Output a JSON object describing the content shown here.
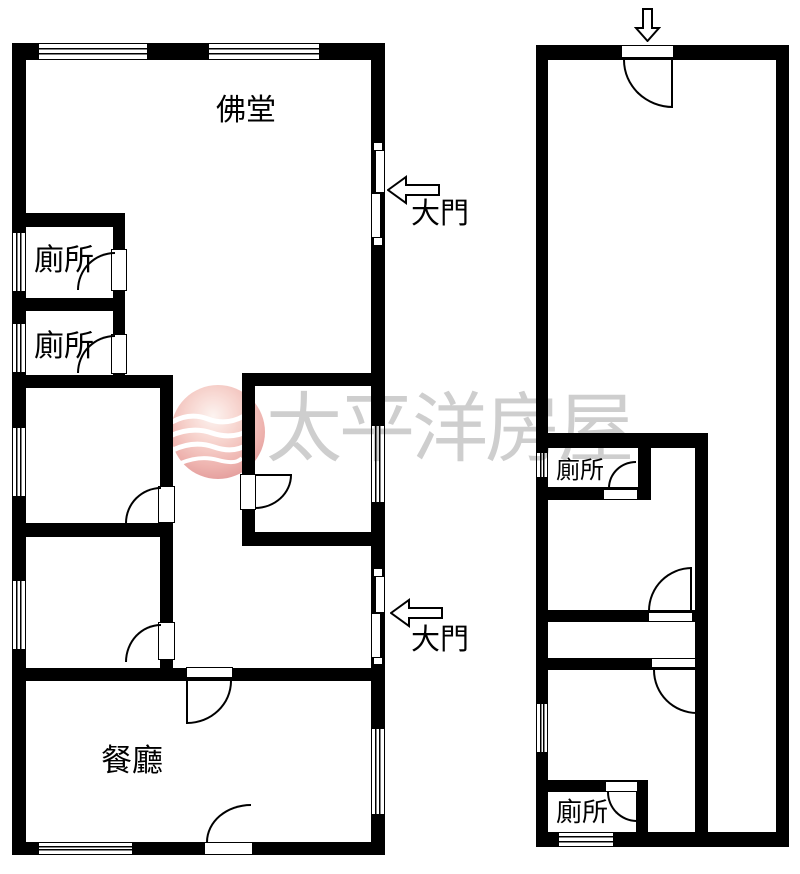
{
  "page": {
    "background": "#ffffff",
    "wall_color": "#000000"
  },
  "labels": {
    "buddha_hall": "佛堂",
    "toilet": "廁所",
    "dining_room": "餐廳",
    "main_door": "大門"
  },
  "watermark": {
    "text": "太平洋房屋",
    "text_color": "#c6c6c6",
    "logo_pink": "#f3bdb6"
  }
}
